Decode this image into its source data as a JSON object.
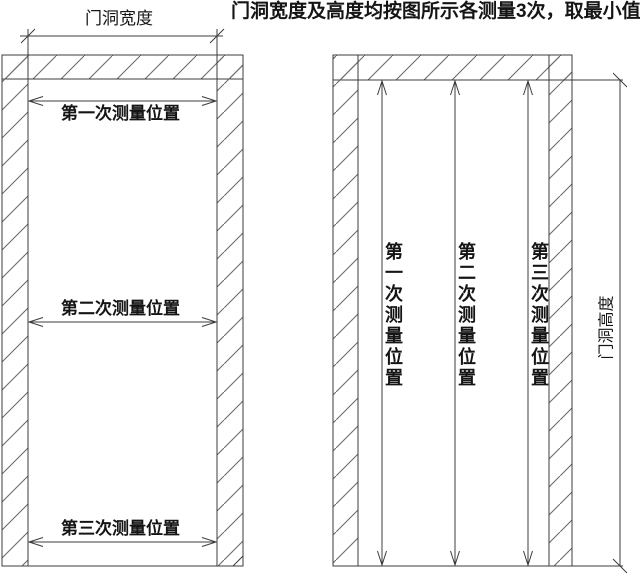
{
  "title": "门洞宽度及高度均按图所示各测量3次，取最小值",
  "left_diagram": {
    "width_dim_label": "门洞宽度",
    "measurements": [
      {
        "label": "第一次测量位置"
      },
      {
        "label": "第二次测量位置"
      },
      {
        "label": "第三次测量位置"
      }
    ]
  },
  "right_diagram": {
    "height_dim_label": "门洞高度",
    "measurements": [
      {
        "label": "第一次测量位置"
      },
      {
        "label": "第二次测量位置"
      },
      {
        "label": "第三次测量位置"
      }
    ]
  },
  "colors": {
    "line": "#3c3c3c",
    "hatch": "#6b6b6b",
    "text": "#151515",
    "background": "#ffffff"
  }
}
